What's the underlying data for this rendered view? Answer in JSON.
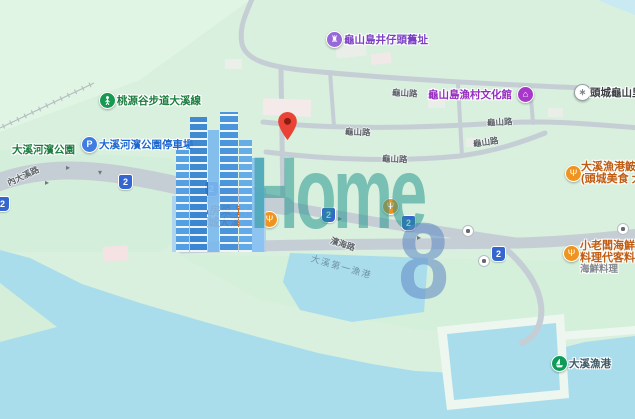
{
  "map_type": "street-map",
  "watermark": {
    "brand": "Home",
    "number": "8"
  },
  "roads": {
    "shield": "2",
    "labels": {
      "neidaxi": "內大溪路",
      "binhai": "濱海路",
      "guishan": "龜山路"
    }
  },
  "water": {
    "inner_harbor": "大溪第一漁港"
  },
  "pois": {
    "monument": {
      "icon": "monument-icon",
      "label": "龜山島井仔頭舊址",
      "color": "#7b3fc4"
    },
    "trailhead": {
      "icon": "hiking-icon",
      "label": "桃源谷步道大溪線",
      "color": "#1c7d3f"
    },
    "park": {
      "label": "大溪河濱公園",
      "color": "#1c7d3f"
    },
    "parking": {
      "icon": "parking-icon",
      "glyph": "P",
      "label": "大溪河濱公園停車場",
      "color": "#1a66d0"
    },
    "culture_hall": {
      "icon": "museum-icon",
      "label": "龜山島漁村文化館",
      "color": "#952bbf"
    },
    "community": {
      "icon": "generic-poi-icon",
      "label": "頭城龜山里活",
      "color": "#3c4043"
    },
    "restaurant_hidden": {
      "icon": "restaurant-icon",
      "line1": "私房菜-宜蘭",
      "line2": "頭城大溪漁港",
      "color": "#c05c12"
    },
    "restaurant_center": {
      "icon": "restaurant-icon"
    },
    "restaurant_fish": {
      "icon": "restaurant-icon",
      "line1": "大溪漁港鮟鱇",
      "line2": "(頭城美食 大",
      "color": "#c05c12"
    },
    "restaurant_boss": {
      "icon": "restaurant-icon",
      "line1": "小老闆海鮮",
      "line2": "料理代客料理",
      "line3": "海鮮料理",
      "color": "#c05c12"
    },
    "harbor": {
      "icon": "harbor-icon",
      "label": "大溪漁港",
      "color": "#3d5a66"
    }
  },
  "colors": {
    "land": "#d8f0dd",
    "water": "#aaddeb",
    "road": "#c5ced5",
    "pin_red": "#ea4335",
    "shield_blue": "#3565cf",
    "restaurant_orange": "#ef9420",
    "park_green": "#169a52",
    "parking_blue": "#3f7de0",
    "monument_purple": "#9668d8",
    "museum_purple": "#a838ca",
    "harbor_green": "#0e9d58",
    "watermark_teal": "rgba(32,148,140,0.52)",
    "watermark_blue": "rgba(92,134,197,0.55)"
  }
}
